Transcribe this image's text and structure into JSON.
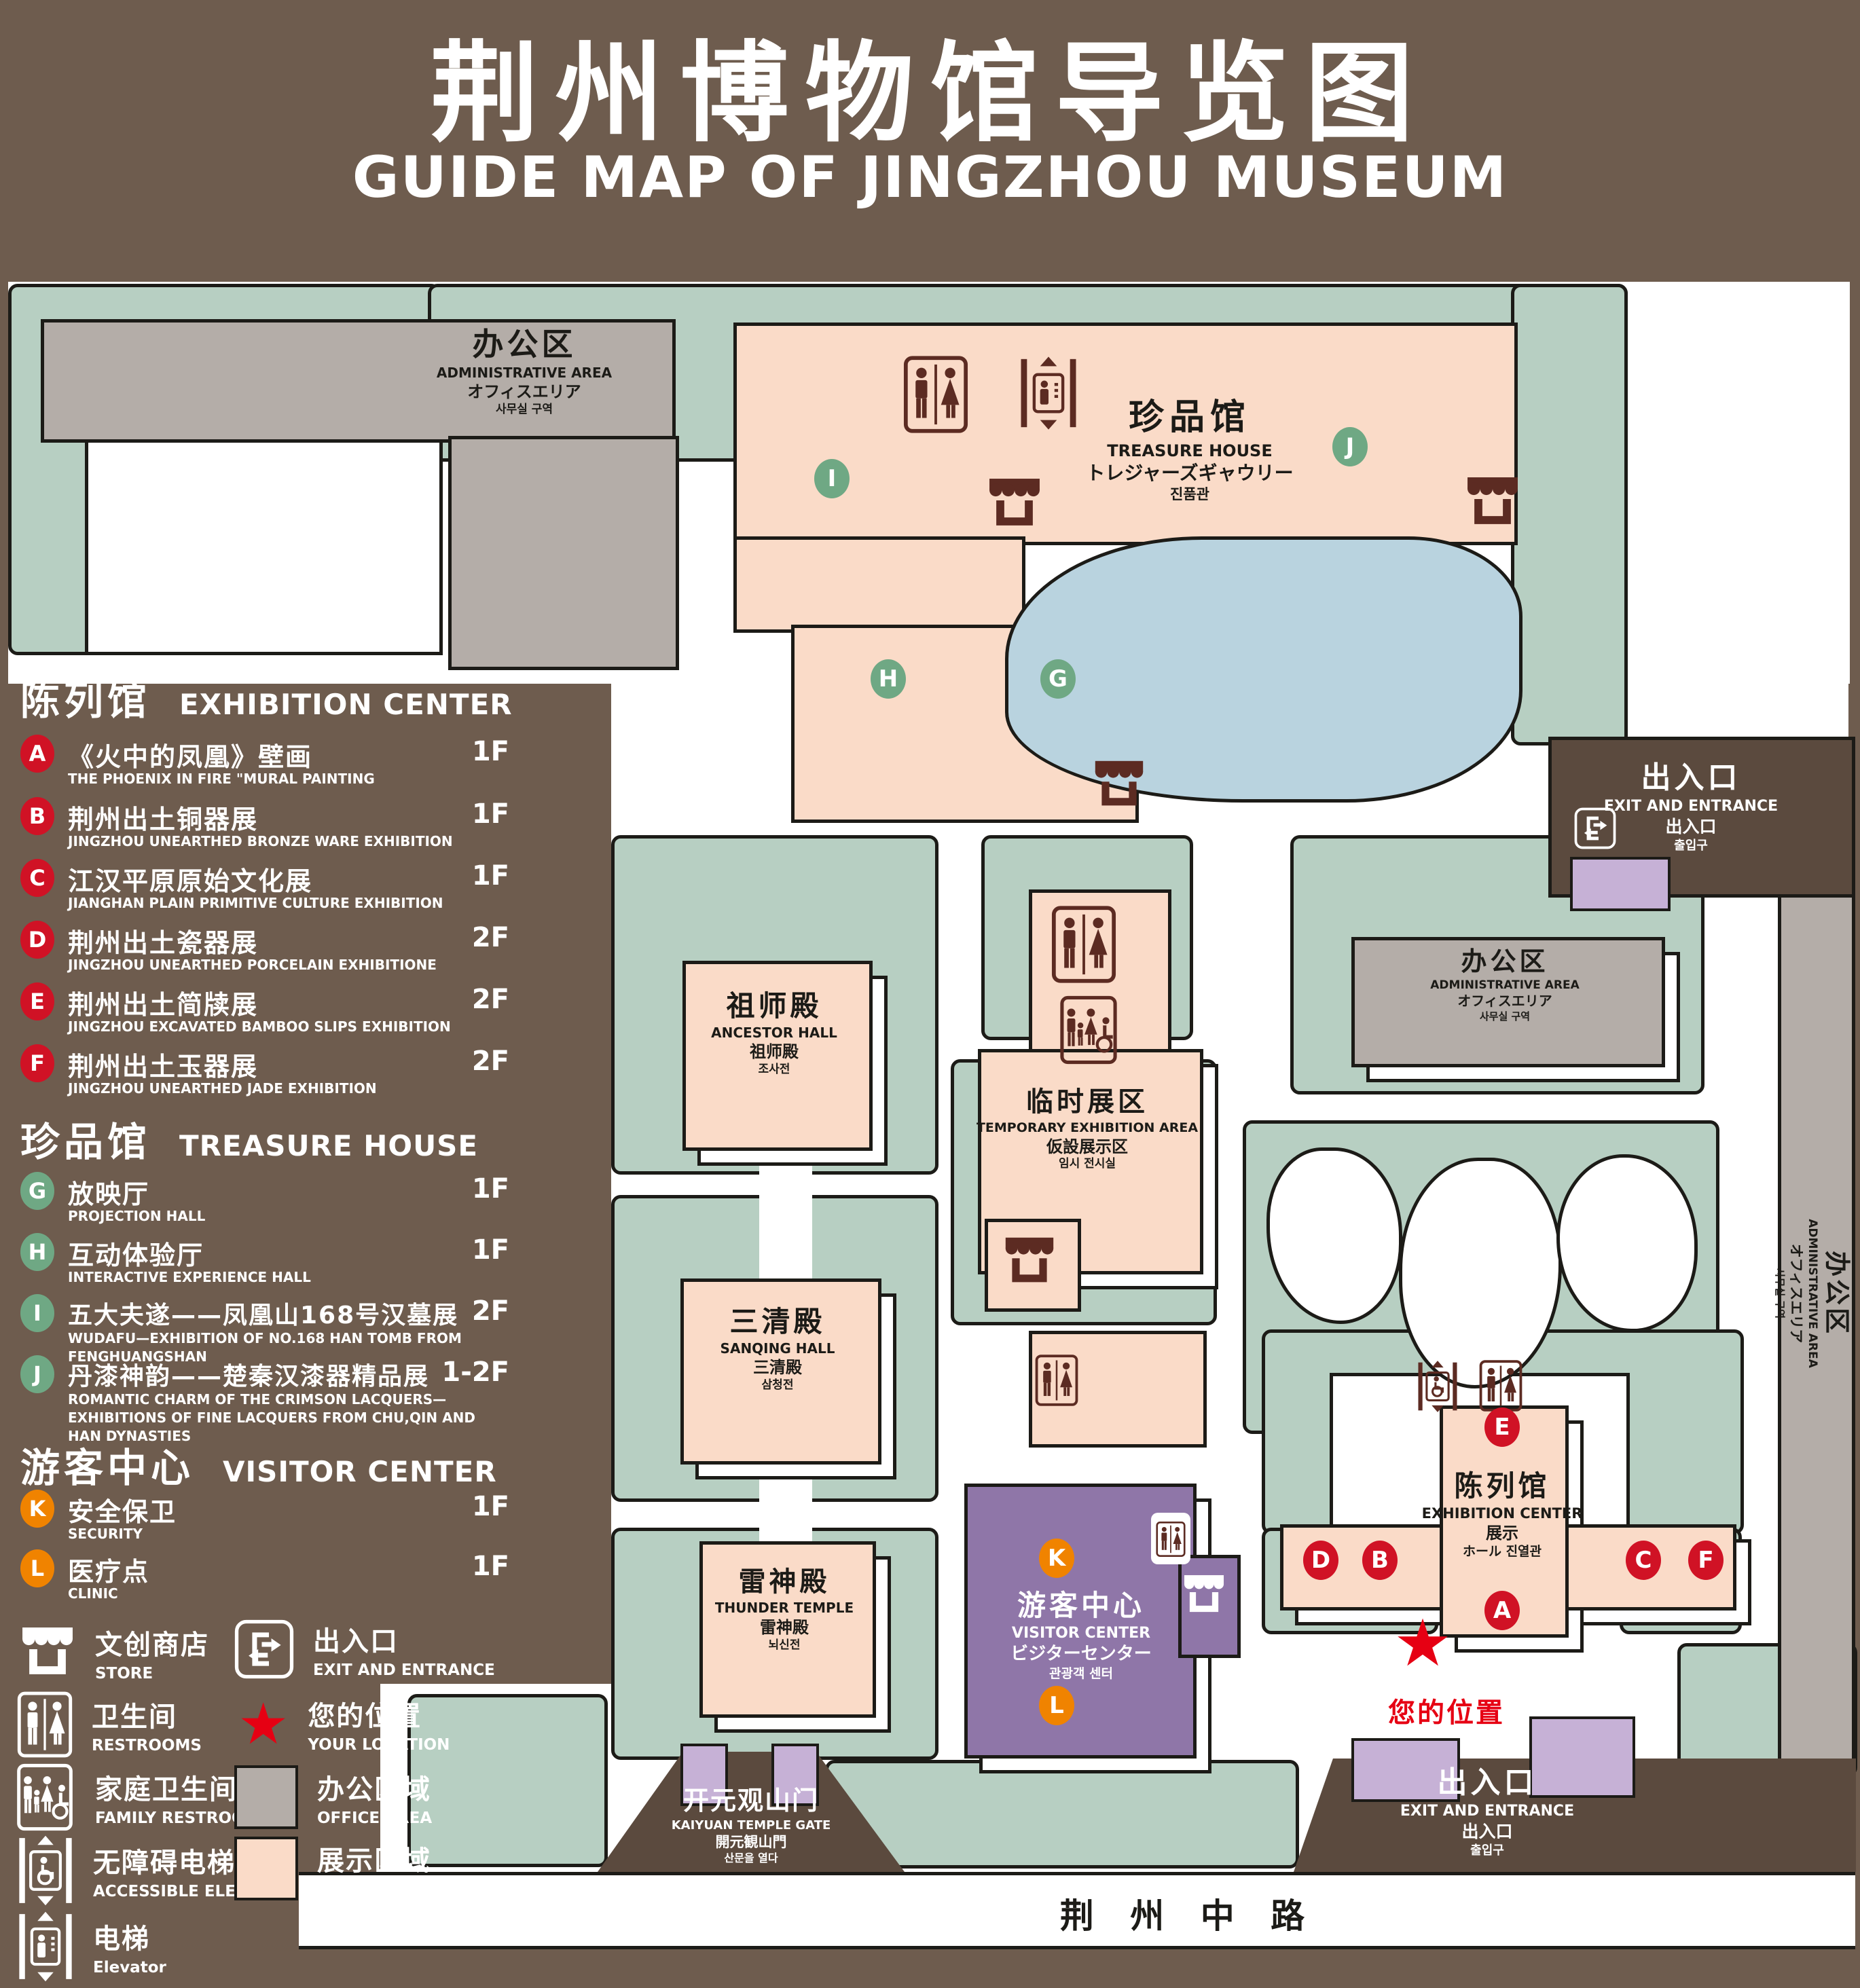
{
  "title": {
    "zh": "荆州博物馆导览图",
    "en": "GUIDE MAP OF JINGZHOU MUSEUM"
  },
  "colors": {
    "background": "#6e5c4e",
    "lawn": "#b7cfc2",
    "display_area": "#fadbc8",
    "office_area": "#b4ada8",
    "lake": "#b9d3df",
    "visitor_purple": "#8f76a8",
    "light_purple": "#c6b1d6",
    "gate_brown": "#5b4a3e",
    "icon_maroon": "#5c2b22",
    "marker_red": "#d01225",
    "marker_green": "#6fa884",
    "marker_orange": "#f08300",
    "star_red": "#e60013"
  },
  "legend": {
    "sections": [
      {
        "zh": "陈列馆",
        "en": "EXHIBITION CENTER",
        "items": [
          {
            "letter": "A",
            "zh": "《火中的凤凰》壁画",
            "en": "THE PHOENIX IN FIRE \"MURAL PAINTING",
            "floor": "1F"
          },
          {
            "letter": "B",
            "zh": "荆州出土铜器展",
            "en": "JINGZHOU UNEARTHED BRONZE WARE EXHIBITION",
            "floor": "1F"
          },
          {
            "letter": "C",
            "zh": "江汉平原原始文化展",
            "en": "JIANGHAN PLAIN PRIMITIVE CULTURE EXHIBITION",
            "floor": "1F"
          },
          {
            "letter": "D",
            "zh": "荆州出土瓷器展",
            "en": "JINGZHOU UNEARTHED PORCELAIN EXHIBITIONE",
            "floor": "2F"
          },
          {
            "letter": "E",
            "zh": "荆州出土简牍展",
            "en": "JINGZHOU EXCAVATED BAMBOO SLIPS EXHIBITION",
            "floor": "2F"
          },
          {
            "letter": "F",
            "zh": "荆州出土玉器展",
            "en": "JINGZHOU UNEARTHED JADE EXHIBITION",
            "floor": "2F"
          }
        ]
      },
      {
        "zh": "珍品馆",
        "en": "TREASURE HOUSE",
        "items": [
          {
            "letter": "G",
            "zh": "放映厅",
            "en": "PROJECTION HALL",
            "floor": "1F"
          },
          {
            "letter": "H",
            "zh": "互动体验厅",
            "en": "INTERACTIVE EXPERIENCE HALL",
            "floor": "1F"
          },
          {
            "letter": "I",
            "zh": "五大夫遂——凤凰山168号汉墓展",
            "en": "WUDAFU—EXHIBITION OF NO.168 HAN TOMB FROM FENGHUANGSHAN",
            "floor": "2F"
          },
          {
            "letter": "J",
            "zh": "丹漆神韵——楚秦汉漆器精品展",
            "en": "ROMANTIC CHARM OF THE CRIMSON LACQUERS—EXHIBITIONS OF FINE LACQUERS FROM CHU,QIN AND HAN DYNASTIES",
            "floor": "1-2F"
          }
        ]
      },
      {
        "zh": "游客中心",
        "en": "VISITOR CENTER",
        "items": [
          {
            "letter": "K",
            "zh": "安全保卫",
            "en": "SECURITY",
            "floor": "1F"
          },
          {
            "letter": "L",
            "zh": "医疗点",
            "en": "CLINIC",
            "floor": "1F"
          }
        ]
      }
    ],
    "symbols": [
      {
        "icon": "store-icon",
        "zh": "文创商店",
        "en": "STORE"
      },
      {
        "icon": "exit-icon",
        "zh": "出入口",
        "en": "EXIT AND ENTRANCE"
      },
      {
        "icon": "restrooms-icon",
        "zh": "卫生间",
        "en": "RESTROOMS"
      },
      {
        "icon": "your-location-star-icon",
        "zh": "您的位置",
        "en": "YOUR LOCATION"
      },
      {
        "icon": "family-restrooms-icon",
        "zh": "家庭卫生间",
        "en": "FAMILY RESTROOMS"
      },
      {
        "icon": "office-area-swatch",
        "zh": "办公区域",
        "en": "OFFICE AREA"
      },
      {
        "icon": "accessible-elevator-icon",
        "zh": "无障碍电梯",
        "en": "ACCESSIBLE ELEVATOR"
      },
      {
        "icon": "display-area-swatch",
        "zh": "展示区域",
        "en": "DISPLAY AREA"
      },
      {
        "icon": "elevator-icon",
        "zh": "电梯",
        "en": "Elevator"
      }
    ]
  },
  "map": {
    "buildings": {
      "admin": {
        "zh": "办公区",
        "en": "ADMINISTRATIVE AREA",
        "ja": "オフィスエリア",
        "ko": "사무실 구역"
      },
      "treasure_house": {
        "zh": "珍品馆",
        "en": "TREASURE HOUSE",
        "ja": "トレジャーズギャウリー",
        "ko": "진품관"
      },
      "ancestor_hall": {
        "zh": "祖师殿",
        "en": "ANCESTOR HALL",
        "ja": "祖师殿",
        "ko": "조사전"
      },
      "temporary_area": {
        "zh": "临时展区",
        "en": "TEMPORARY EXHIBITION AREA",
        "ja": "仮設展示区",
        "ko": "임시 전시실"
      },
      "sanqing_hall": {
        "zh": "三清殿",
        "en": "SANQING HALL",
        "ja": "三清殿",
        "ko": "삼청전"
      },
      "thunder_temple": {
        "zh": "雷神殿",
        "en": "THUNDER TEMPLE",
        "ja": "雷神殿",
        "ko": "뇌신전"
      },
      "visitor_center": {
        "zh": "游客中心",
        "en": "VISITOR CENTER",
        "ja": "ビジターセンター",
        "ko": "관광객 센터"
      },
      "exhibition_center": {
        "zh": "陈列馆",
        "en": "EXHIBITION CENTER",
        "ja": "展示",
        "ko": "ホール 진열관"
      },
      "kaiyuan_gate": {
        "zh": "开元观山门",
        "en": "KAIYUAN TEMPLE GATE",
        "ja": "開元観山門",
        "ko": "산문을 열다"
      },
      "exit": {
        "zh": "出入口",
        "en": "EXIT AND ENTRANCE",
        "ja": "出入口",
        "ko": "출입구"
      }
    },
    "road": "荆 州 中 路",
    "your_location": "您的位置",
    "markers": {
      "a": "A",
      "b": "B",
      "c": "C",
      "d": "D",
      "e": "E",
      "f": "F",
      "g": "G",
      "h": "H",
      "i": "I",
      "j": "J",
      "k": "K",
      "l": "L"
    }
  }
}
